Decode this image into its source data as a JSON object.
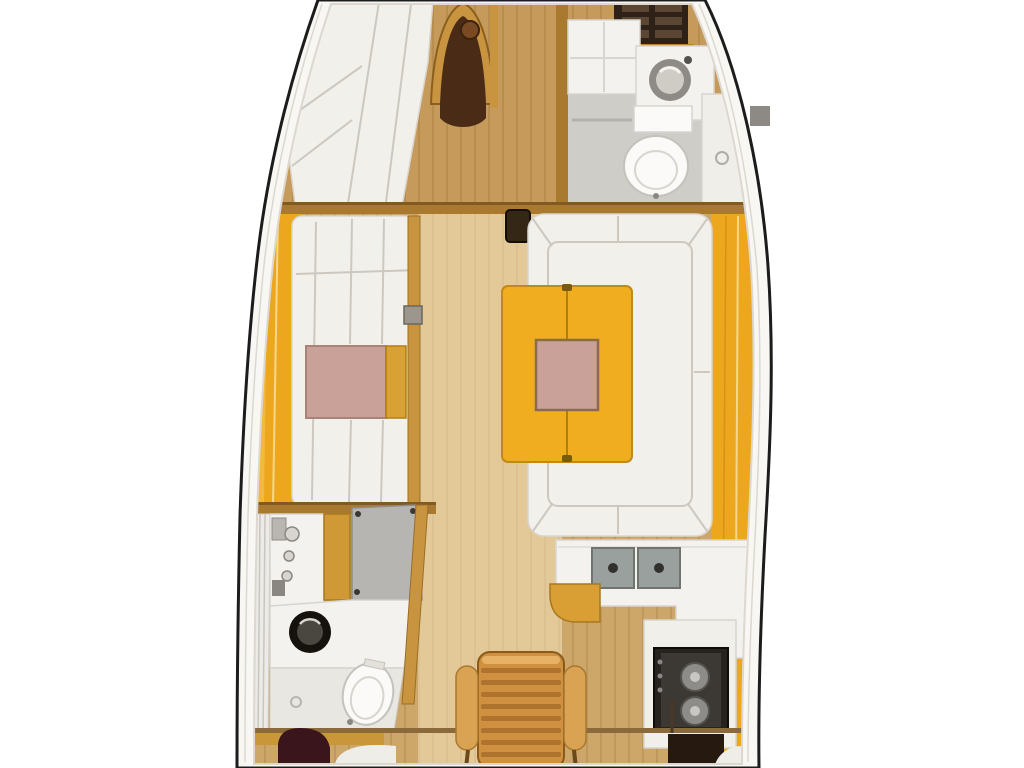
{
  "scene": {
    "description": "sailboat-yacht-interior-floor-plan-top-view"
  },
  "colors": {
    "background": "#ffffff",
    "hull_outline": "#1c1c1c",
    "deck_rim": "#f8f7f4",
    "inner_rim_line": "#ddd8cf",
    "floor_wood": "#cda769",
    "bow_floor_tint": "rgba(170,108,38,0.22)",
    "walkway_light": "rgba(250,233,200,0.5)",
    "plank_line": "rgba(128,86,34,0.18)",
    "bulkhead_wood": "#a8792f",
    "trim_wood": "#c89440",
    "panel_amber": "#eca71f",
    "panel_amber_light": "#f5c04c",
    "table_amber": "#f0ad1f",
    "table_amber_leaf": "#d9a033",
    "table_pink": "#c9a198",
    "cushion_white": "#f2f0ea",
    "cushion_seam": "#ccc8c0",
    "head_floor": "#cfcdc8",
    "white_counter": "#f4f2ee",
    "counter_edge": "#d8d4cf",
    "toilet_white": "#fbfaf8",
    "sink_steel": "#9aa09e",
    "drain_dark": "#32302c",
    "basin_dark": "#15120e",
    "shower_gray": "#b7b5b1",
    "fixture_gray": "#8a8782",
    "stove_dark": "#26221e",
    "stove_inner": "#3c3834",
    "burner_gray": "#8e8c88",
    "steps_orange": "#cf9040",
    "steps_rung_shadow": "rgba(110,64,16,0.35)",
    "arm_tan": "#daa353",
    "rail_wood": "#8a6a3a",
    "post_dark": "#352716",
    "hatch_dark": "#2e2218",
    "hatch_slat": "#5a4632",
    "aft_cabin_port_dark": "#3a161c",
    "aft_cabin_starboard_dark": "#261a10",
    "pale_bedding": "#efede8",
    "arch_inner_dark": "#4a2c16"
  },
  "fixtures": {
    "hull": "sailboat-hull",
    "v_berth": "v-berth-bed",
    "arch_door": "forward-cabin-arched-doorway",
    "bow_hatch": "bow-hatch-steps",
    "fore_head_sink": "forward-head-washbasin",
    "fore_head_toilet": "forward-head-toilet",
    "fore_head_shower": "forward-head-shower",
    "port_settee": "port-settee",
    "settee_table": "port-settee-table",
    "mast_post": "mast-post",
    "dinette_sofa": "u-shaped-dinette-sofa",
    "dinette_table": "dinette-table",
    "galley_counter": "galley-counter",
    "galley_sink": "galley-double-sink",
    "stove": "galley-stove",
    "aft_head_vanity": "aft-head-vanity",
    "aft_head_basin": "aft-head-washbasin",
    "aft_head_toilet": "aft-head-toilet",
    "aft_head_shower": "aft-head-shower-panel",
    "companionway": "companionway-steps",
    "aft_cabin_port": "aft-cabin-port",
    "aft_cabin_starboard": "aft-cabin-starboard"
  }
}
